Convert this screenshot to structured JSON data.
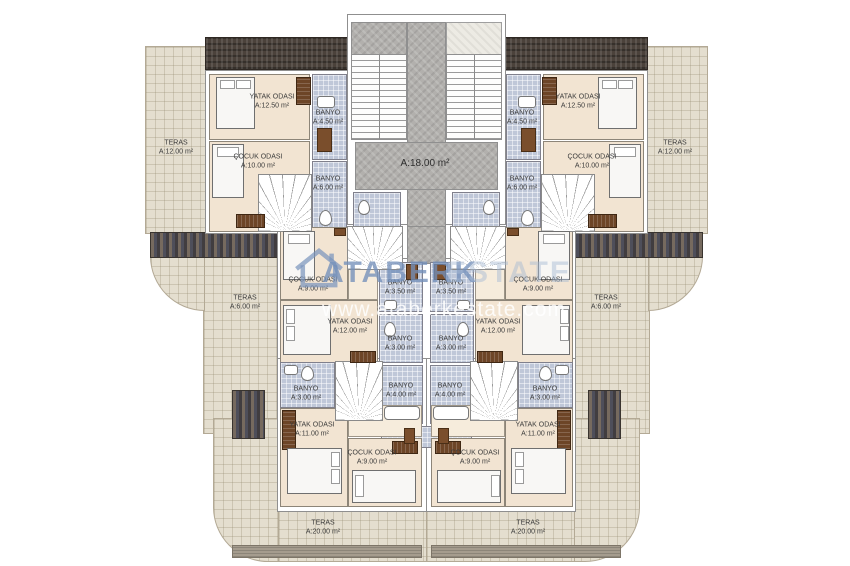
{
  "watermark": {
    "brand": "ATABERK",
    "brand_suffix": "ESTATE",
    "url": "www.ataberkestate.com",
    "logo_icon": "house-icon"
  },
  "rooms": {
    "hall": {
      "area": "A:18.00 m²"
    },
    "top": {
      "teras": {
        "name": "TERAS",
        "area": "A:12.00 m²"
      },
      "yatak": {
        "name": "YATAK ODASI",
        "area": "A:12.50 m²"
      },
      "cocuk": {
        "name": "ÇOCUK ODASI",
        "area": "A:10.00 m²"
      },
      "banyo_a": {
        "name": "BANYO",
        "area": "A:4.50 m²"
      },
      "banyo_b": {
        "name": "BANYO",
        "area": "A:6.00 m²"
      }
    },
    "mid": {
      "teras": {
        "name": "TERAS",
        "area": "A:6.00 m²"
      },
      "cocuk": {
        "name": "ÇOCUK ODASI",
        "area": "A:9.00 m²"
      },
      "yatak": {
        "name": "YATAK ODASI",
        "area": "A:12.00 m²"
      },
      "banyo_a": {
        "name": "BANYO",
        "area": "A:3.50 m²"
      },
      "banyo_b": {
        "name": "BANYO",
        "area": "A:3.00 m²"
      },
      "banyo_c": {
        "name": "BANYO",
        "area": "A:4.00 m²"
      }
    },
    "bottom": {
      "banyo_a": {
        "name": "BANYO",
        "area": "A:3.00 m²"
      },
      "yatak": {
        "name": "YATAK ODASI",
        "area": "A:11.00 m²"
      },
      "cocuk": {
        "name": "ÇOCUK ODASI",
        "area": "A:9.00 m²"
      },
      "teras": {
        "name": "TERAS",
        "area": "A:20.00 m²"
      }
    }
  },
  "colors": {
    "room_fill": "#f2e4d2",
    "bathroom_fill": "#bfc7d8",
    "terrace_fill": "#e4decf",
    "hall_fill": "#b2b0ad",
    "roof_dark": "#4b423b",
    "watermark_blue": "#7d95bd"
  }
}
